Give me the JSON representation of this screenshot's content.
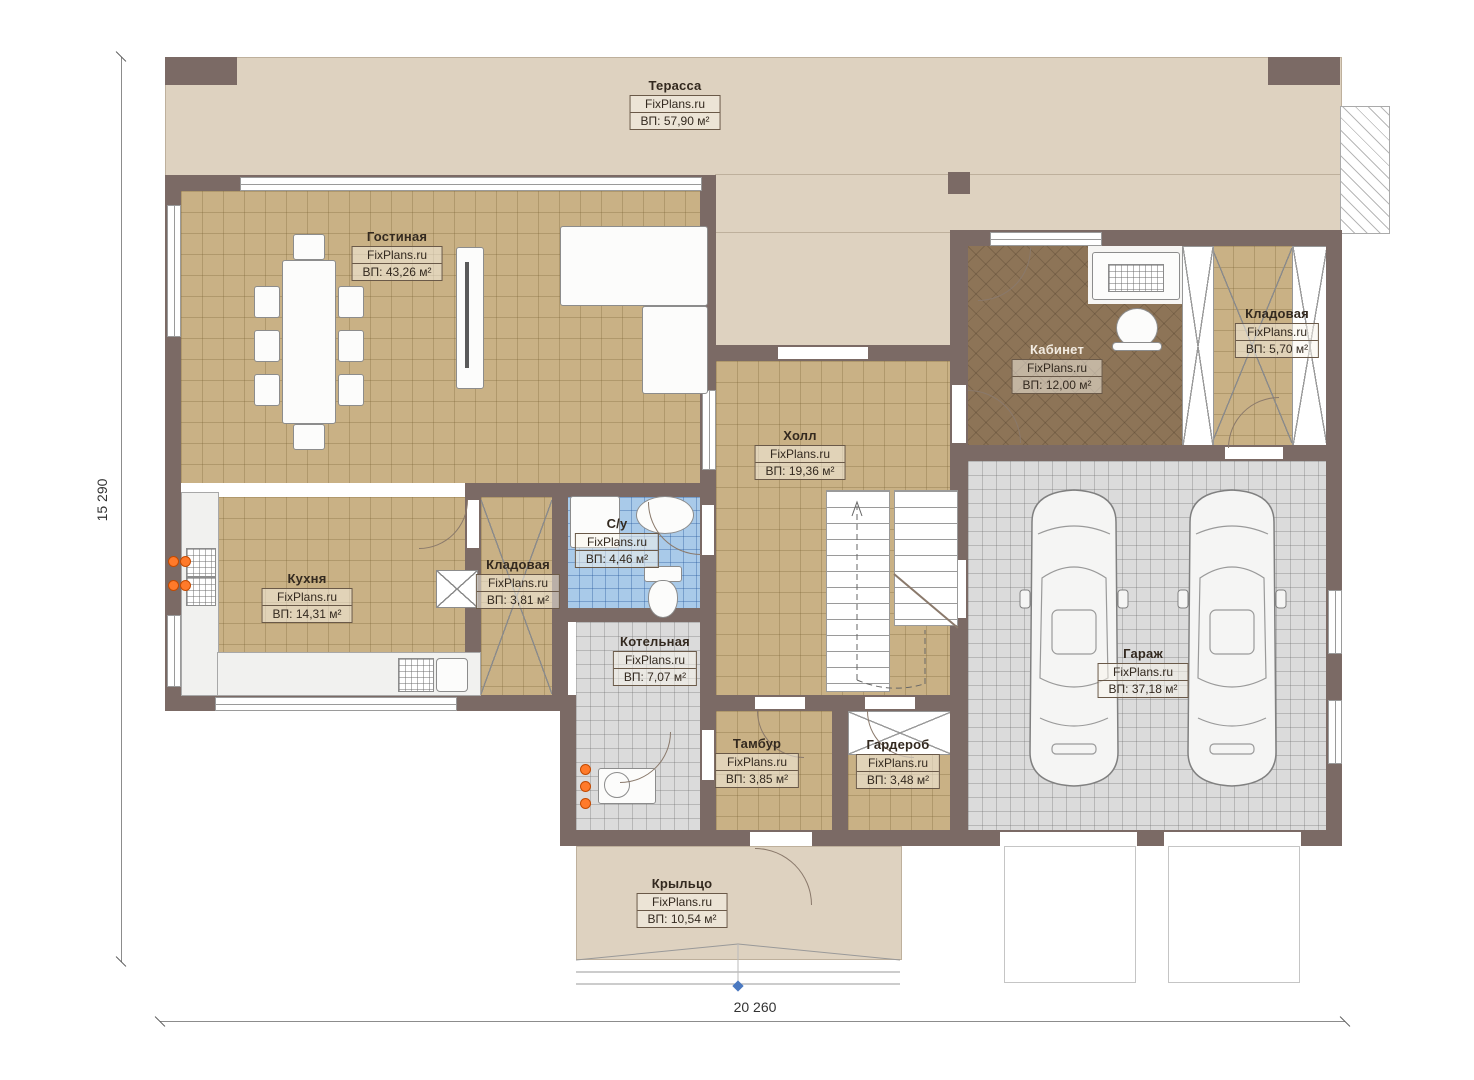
{
  "brand": "FixPlans.ru",
  "dimensions": {
    "height_label": "15 290",
    "width_label": "20 260"
  },
  "colors": {
    "wall": "#7b6a65",
    "terrace": "#ded2c0",
    "floor_tan": "#c9b185",
    "floor_office": "#8d7457",
    "floor_blue": "#a9cae9",
    "floor_grey": "#dbdbdb",
    "accent_orange": "#ff7a2a",
    "label_border": "#6a5948",
    "marker_blue": "#4a78c0"
  },
  "rooms": [
    {
      "id": "terrace",
      "name": "Терасса",
      "brand": "FixPlans.ru",
      "area": "ВП: 57,90 м²"
    },
    {
      "id": "living",
      "name": "Гостиная",
      "brand": "FixPlans.ru",
      "area": "ВП: 43,26 м²"
    },
    {
      "id": "office",
      "name": "Кабинет",
      "brand": "FixPlans.ru",
      "area": "ВП: 12,00 м²"
    },
    {
      "id": "storage-right",
      "name": "Кладовая",
      "brand": "FixPlans.ru",
      "area": "ВП: 5,70 м²"
    },
    {
      "id": "hall",
      "name": "Холл",
      "brand": "FixPlans.ru",
      "area": "ВП: 19,36 м²"
    },
    {
      "id": "kitchen",
      "name": "Кухня",
      "brand": "FixPlans.ru",
      "area": "ВП: 14,31 м²"
    },
    {
      "id": "storage-mid",
      "name": "Кладовая",
      "brand": "FixPlans.ru",
      "area": "ВП: 3,81 м²"
    },
    {
      "id": "bathroom",
      "name": "С/у",
      "brand": "FixPlans.ru",
      "area": "ВП: 4,46 м²"
    },
    {
      "id": "boiler",
      "name": "Котельная",
      "brand": "FixPlans.ru",
      "area": "ВП: 7,07 м²"
    },
    {
      "id": "tambour",
      "name": "Тамбур",
      "brand": "FixPlans.ru",
      "area": "ВП: 3,85 м²"
    },
    {
      "id": "wardrobe",
      "name": "Гардероб",
      "brand": "FixPlans.ru",
      "area": "ВП: 3,48 м²"
    },
    {
      "id": "garage",
      "name": "Гараж",
      "brand": "FixPlans.ru",
      "area": "ВП: 37,18 м²"
    },
    {
      "id": "porch",
      "name": "Крыльцо",
      "brand": "FixPlans.ru",
      "area": "ВП: 10,54 м²"
    }
  ]
}
